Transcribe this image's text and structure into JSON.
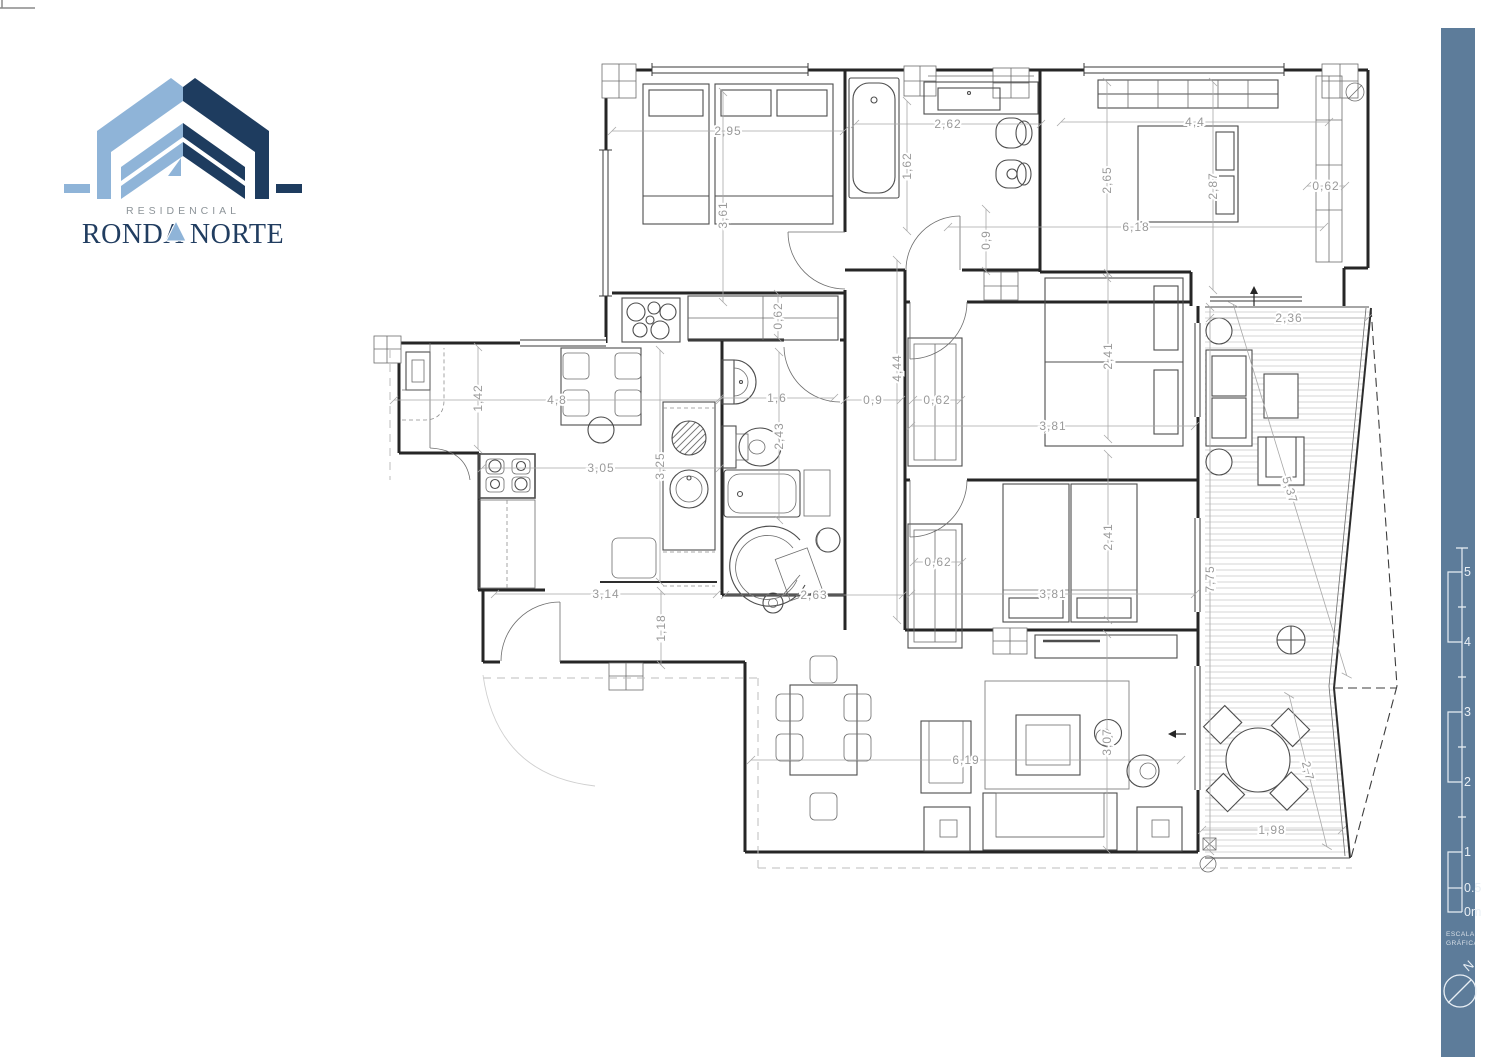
{
  "brand": {
    "line1": "RESIDENCIAL",
    "line2": "RONDA NORTE"
  },
  "sidebar": {
    "caption_line1": "ESCALA",
    "caption_line2": "GRÁFICA",
    "north": "N",
    "accent_color": "#5d7c9a",
    "scale_labels": [
      {
        "t": "5",
        "y": 572
      },
      {
        "t": "4",
        "y": 642
      },
      {
        "t": "3",
        "y": 712
      },
      {
        "t": "2",
        "y": 782
      },
      {
        "t": "1",
        "y": 852
      },
      {
        "t": "0.5",
        "y": 888
      },
      {
        "t": "0m",
        "y": 912
      }
    ]
  },
  "dimensions": [
    {
      "t": "2,95",
      "x": 728,
      "y": 131,
      "r": 0,
      "l": 232
    },
    {
      "t": "1,62",
      "x": 907,
      "y": 166,
      "r": -90,
      "l": 130
    },
    {
      "t": "2,62",
      "x": 948,
      "y": 124,
      "r": 0,
      "l": 186
    },
    {
      "t": "4,4",
      "x": 1195,
      "y": 122,
      "r": 0,
      "l": 268
    },
    {
      "t": "3,61",
      "x": 723,
      "y": 197,
      "r": -90,
      "l": 210,
      "o": -18
    },
    {
      "t": "2,65",
      "x": 1107,
      "y": 180,
      "r": -90,
      "l": 196
    },
    {
      "t": "2,87",
      "x": 1213,
      "y": 186,
      "r": -90,
      "l": 208
    },
    {
      "t": "0,62",
      "x": 1326,
      "y": 186,
      "r": 0,
      "l": 38
    },
    {
      "t": "6,18",
      "x": 1136,
      "y": 227,
      "r": 0,
      "l": 376
    },
    {
      "t": "0,9",
      "x": 986,
      "y": 240,
      "r": -90,
      "l": 62
    },
    {
      "t": "2,36",
      "x": 1289,
      "y": 318,
      "r": 0,
      "l": 158
    },
    {
      "t": "0,62",
      "x": 778,
      "y": 316,
      "r": -90,
      "l": 44
    },
    {
      "t": "1,42",
      "x": 478,
      "y": 398,
      "r": -90,
      "l": 102
    },
    {
      "t": "4,8",
      "x": 557,
      "y": 400,
      "r": 0,
      "l": 326
    },
    {
      "t": "1,6",
      "x": 777,
      "y": 398,
      "r": 0,
      "l": 114
    },
    {
      "t": "0,9",
      "x": 873,
      "y": 400,
      "r": 0,
      "l": 56
    },
    {
      "t": "0,62",
      "x": 937,
      "y": 400,
      "r": 0,
      "l": 48
    },
    {
      "t": "4,44",
      "x": 897,
      "y": 440,
      "r": -90,
      "l": 360,
      "o": 72
    },
    {
      "t": "2,41",
      "x": 1108,
      "y": 356,
      "r": -90,
      "l": 166
    },
    {
      "t": "3,81",
      "x": 1053,
      "y": 426,
      "r": 0,
      "l": 284
    },
    {
      "t": "2,43",
      "x": 779,
      "y": 436,
      "r": -90,
      "l": 168
    },
    {
      "t": "3,25",
      "x": 660,
      "y": 466,
      "r": -90,
      "l": 232
    },
    {
      "t": "3,05",
      "x": 601,
      "y": 468,
      "r": 0,
      "l": 238
    },
    {
      "t": "0,62",
      "x": 938,
      "y": 562,
      "r": 0,
      "l": 48
    },
    {
      "t": "2,41",
      "x": 1108,
      "y": 537,
      "r": -90,
      "l": 166
    },
    {
      "t": "3,81",
      "x": 1053,
      "y": 594,
      "r": 0,
      "l": 284
    },
    {
      "t": "7,75",
      "x": 1210,
      "y": 579,
      "r": -90,
      "l": 544
    },
    {
      "t": "5,37",
      "x": 1290,
      "y": 490,
      "r": 73,
      "l": 388
    },
    {
      "t": "3,14",
      "x": 606,
      "y": 594,
      "r": 0,
      "l": 222
    },
    {
      "t": "1,18",
      "x": 661,
      "y": 628,
      "r": -90,
      "l": 74
    },
    {
      "t": "2,63",
      "x": 814,
      "y": 595,
      "r": 0,
      "l": 178
    },
    {
      "t": "6,19",
      "x": 966,
      "y": 760,
      "r": 0,
      "l": 430
    },
    {
      "t": "3,07",
      "x": 1107,
      "y": 742,
      "r": -90,
      "l": 216
    },
    {
      "t": "2,7",
      "x": 1308,
      "y": 771,
      "r": 76,
      "l": 156
    },
    {
      "t": "1,98",
      "x": 1272,
      "y": 830,
      "r": 0,
      "l": 140
    }
  ]
}
